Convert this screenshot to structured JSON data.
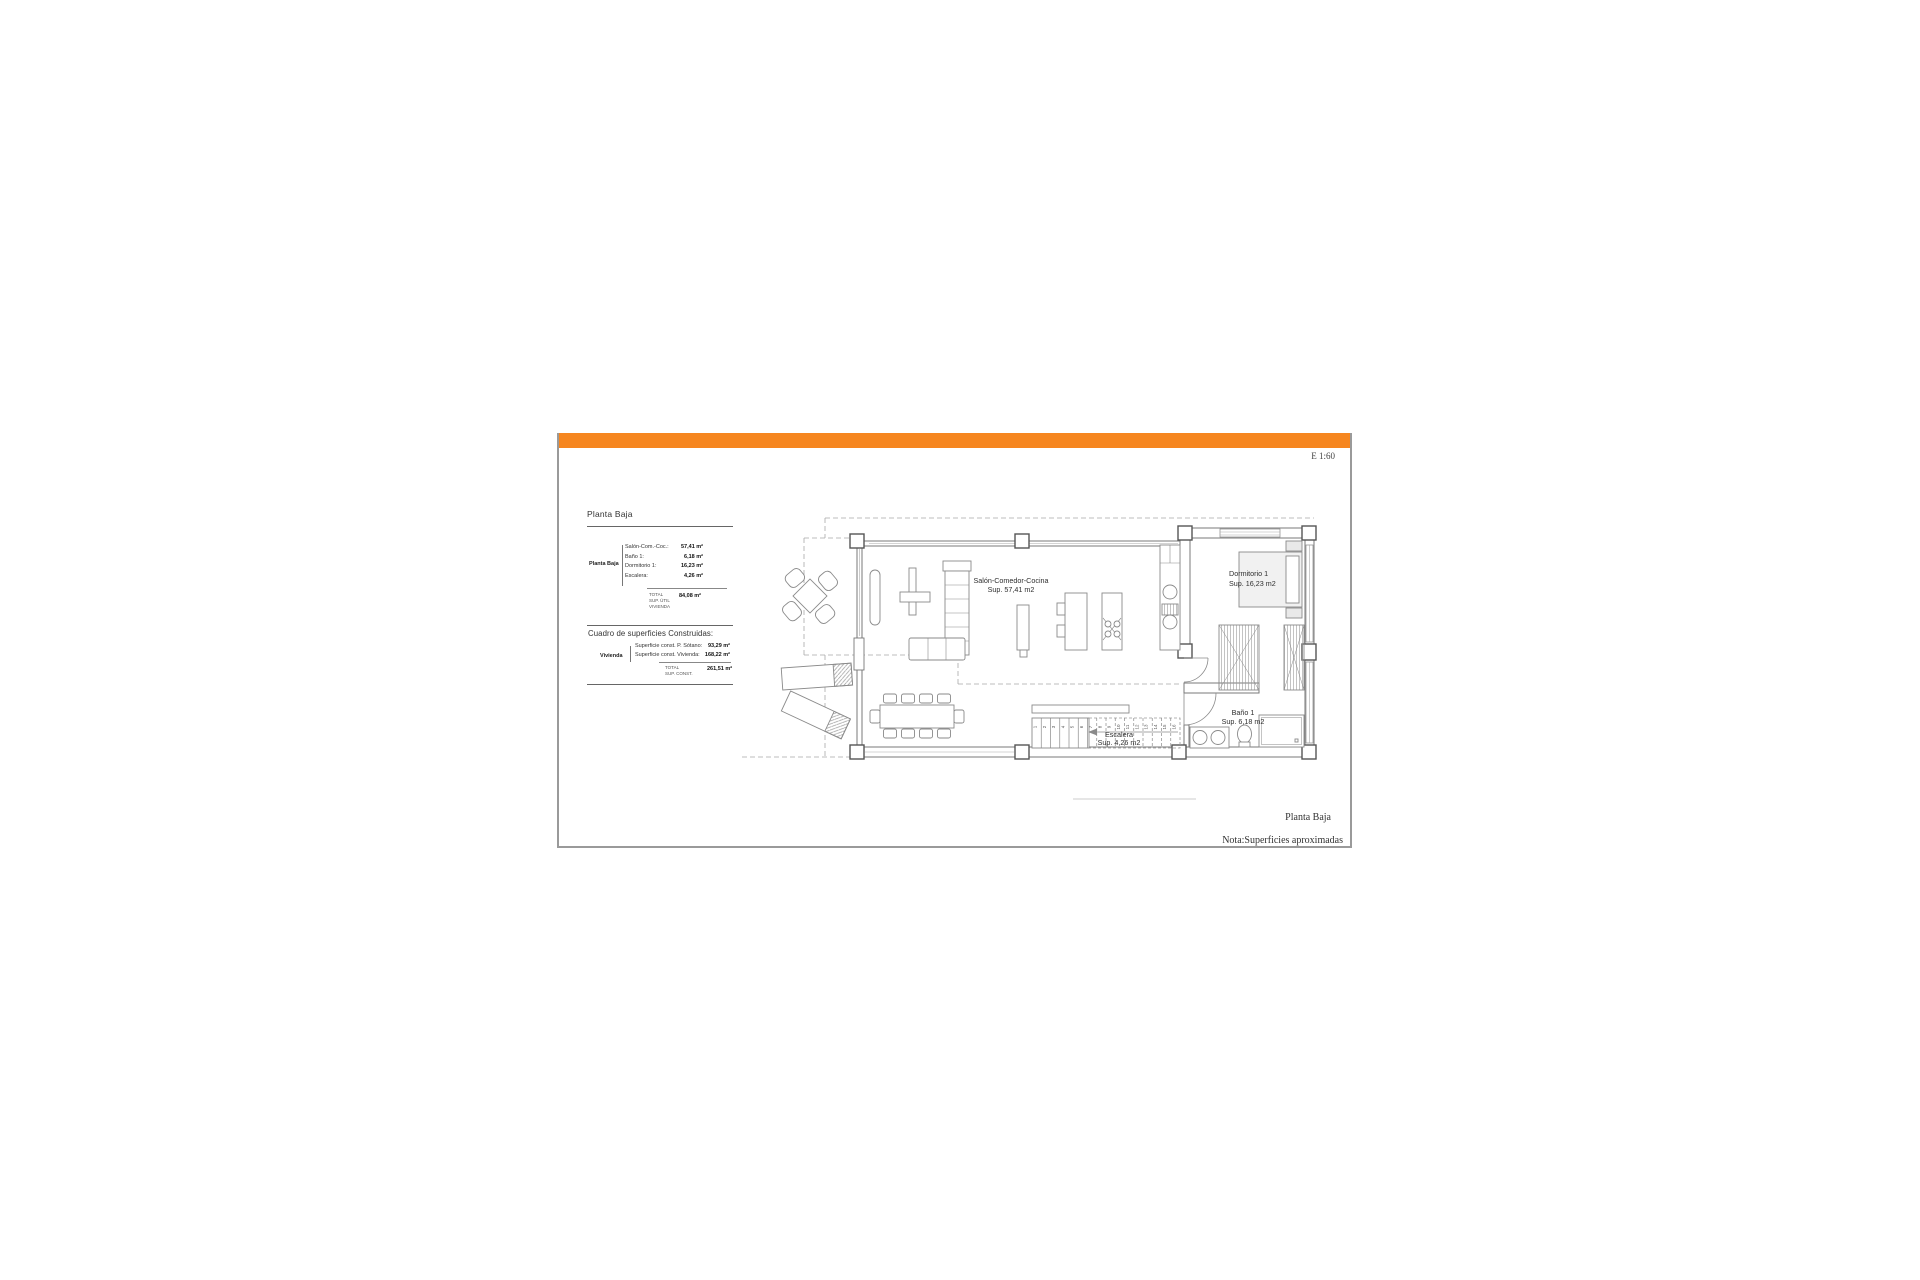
{
  "scale_label": "E 1:60",
  "colors": {
    "accent_orange": "#F6861F"
  },
  "left_panel": {
    "section1": {
      "title": "Planta Baja",
      "group_label": "Planta Baja",
      "rows": [
        {
          "label": "Salón-Com.-Coc.:",
          "value": "57,41 m²"
        },
        {
          "label": "Baño 1:",
          "value": "6,18 m²"
        },
        {
          "label": "Dormitorio 1:",
          "value": "16,23 m²"
        },
        {
          "label": "Escalera:",
          "value": "4,26 m²"
        }
      ],
      "total_label_lines": [
        "TOTAL",
        "SUP. ÚTIL",
        "VIVIENDA"
      ],
      "total_value": "84,08 m²"
    },
    "section2": {
      "title": "Cuadro de superficies Construidas:",
      "group_label": "Vivienda",
      "rows": [
        {
          "label": "Superficie const. P. Sótano:",
          "value": "93,29 m²"
        },
        {
          "label": "Superficie const. Vivienda:",
          "value": "168,22 m²"
        }
      ],
      "total_label_lines": [
        "TOTAL",
        "SUP. CONST."
      ],
      "total_value": "261,51 m²"
    }
  },
  "plan": {
    "rooms": [
      {
        "name": "Salón-Comedor-Cocina",
        "area": "Sup. 57,41 m2"
      },
      {
        "name": "Dormitorio 1",
        "area": "Sup. 16,23 m2"
      },
      {
        "name": "Baño 1",
        "area": "Sup. 6,18 m2"
      },
      {
        "name": "Escalera",
        "area": "Sup. 4,26 m2"
      }
    ],
    "stair_steps": [
      "1",
      "2",
      "3",
      "4",
      "5",
      "6",
      "7",
      "8",
      "9",
      "10",
      "11",
      "12",
      "13",
      "14",
      "15",
      "16"
    ]
  },
  "footer": {
    "drawing_title": "Planta Baja",
    "note": "Nota:Superficies aproximadas"
  }
}
